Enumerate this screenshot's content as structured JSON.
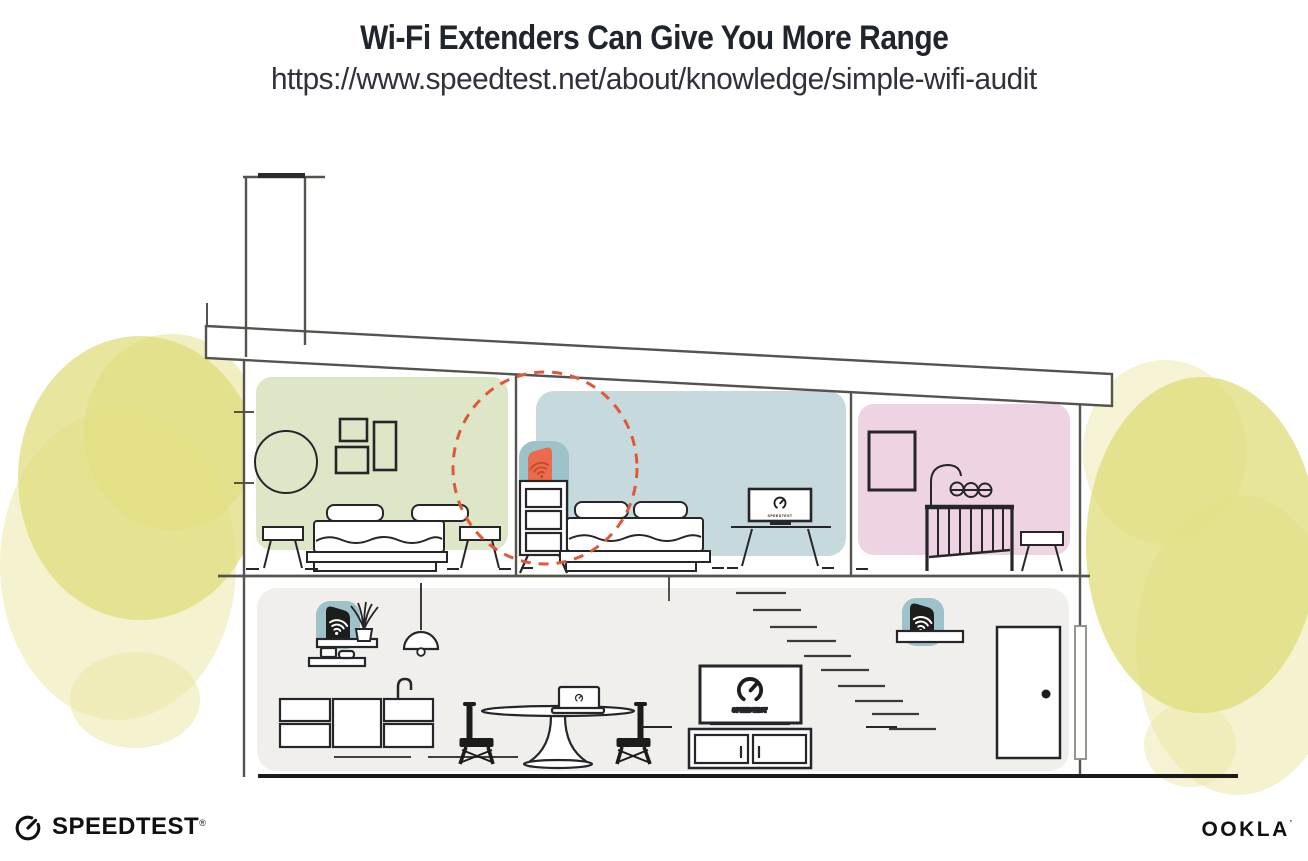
{
  "header": {
    "title": "Wi-Fi Extenders Can Give You More Range",
    "url": "https://www.speedtest.net/about/knowledge/simple-wifi-audit"
  },
  "illustration": {
    "tv_label": "SPEEDTEST",
    "colors": {
      "room_green": "#dde6c6",
      "room_blue": "#c6d9dc",
      "room_pink": "#eed4e3",
      "floor_gray": "#f0efec",
      "blob_teal": "#9dc2ca",
      "extender_orange": "#ec6a4d",
      "wifi_on_orange": "#c24e2b",
      "wifi_white": "#ffffff",
      "device_black": "#1d1d1b",
      "dashed_red": "#e0583a",
      "tree_yellow": "#dfdc78",
      "tree_yellow_light": "#ebe8a8"
    }
  },
  "footer": {
    "speedtest_label": "SPEEDTEST",
    "speedtest_mark": "®",
    "ookla_label": "OOKLA",
    "ookla_mark": "’"
  }
}
